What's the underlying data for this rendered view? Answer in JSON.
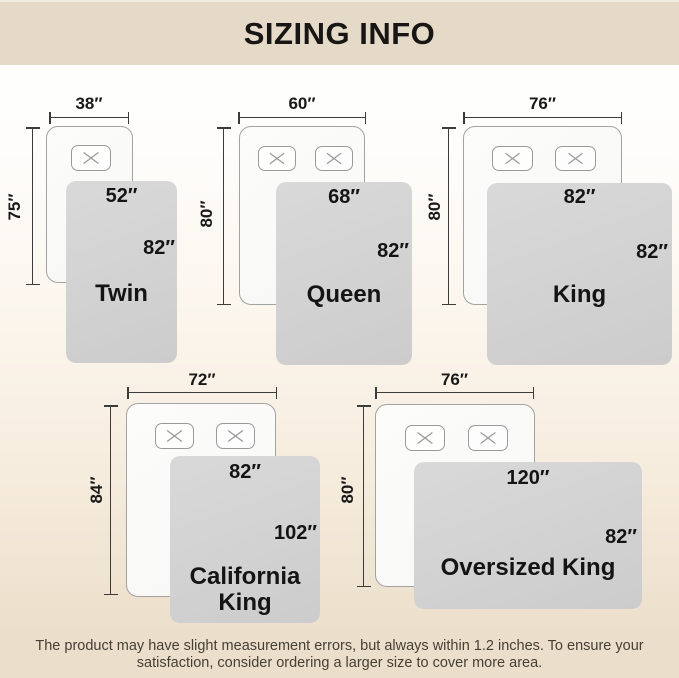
{
  "header": {
    "title": "SIZING INFO"
  },
  "sizes": [
    {
      "name": "Twin",
      "bed_width": "38″",
      "bed_length": "75″",
      "blanket_width": "52″",
      "blanket_length": "82″",
      "pillow_count": 1
    },
    {
      "name": "Queen",
      "bed_width": "60″",
      "bed_length": "80″",
      "blanket_width": "68″",
      "blanket_length": "82″",
      "pillow_count": 2
    },
    {
      "name": "King",
      "bed_width": "76″",
      "bed_length": "80″",
      "blanket_width": "82″",
      "blanket_length": "82″",
      "pillow_count": 2
    },
    {
      "name": "California King",
      "bed_width": "72″",
      "bed_length": "84″",
      "blanket_width": "82″",
      "blanket_length": "102″",
      "pillow_count": 2
    },
    {
      "name": "Oversized King",
      "bed_width": "76″",
      "bed_length": "80″",
      "blanket_width": "120″",
      "blanket_length": "82″",
      "pillow_count": 2
    }
  ],
  "footer": {
    "line1": "The product may have slight measurement errors, but always within 1.2 inches. To ensure your",
    "line2": "satisfaction, consider ordering a larger size to cover more area."
  },
  "colors": {
    "banner": "#e5dac7",
    "blanket_gray": "#d3d3d3",
    "text": "#1a1a1a"
  }
}
